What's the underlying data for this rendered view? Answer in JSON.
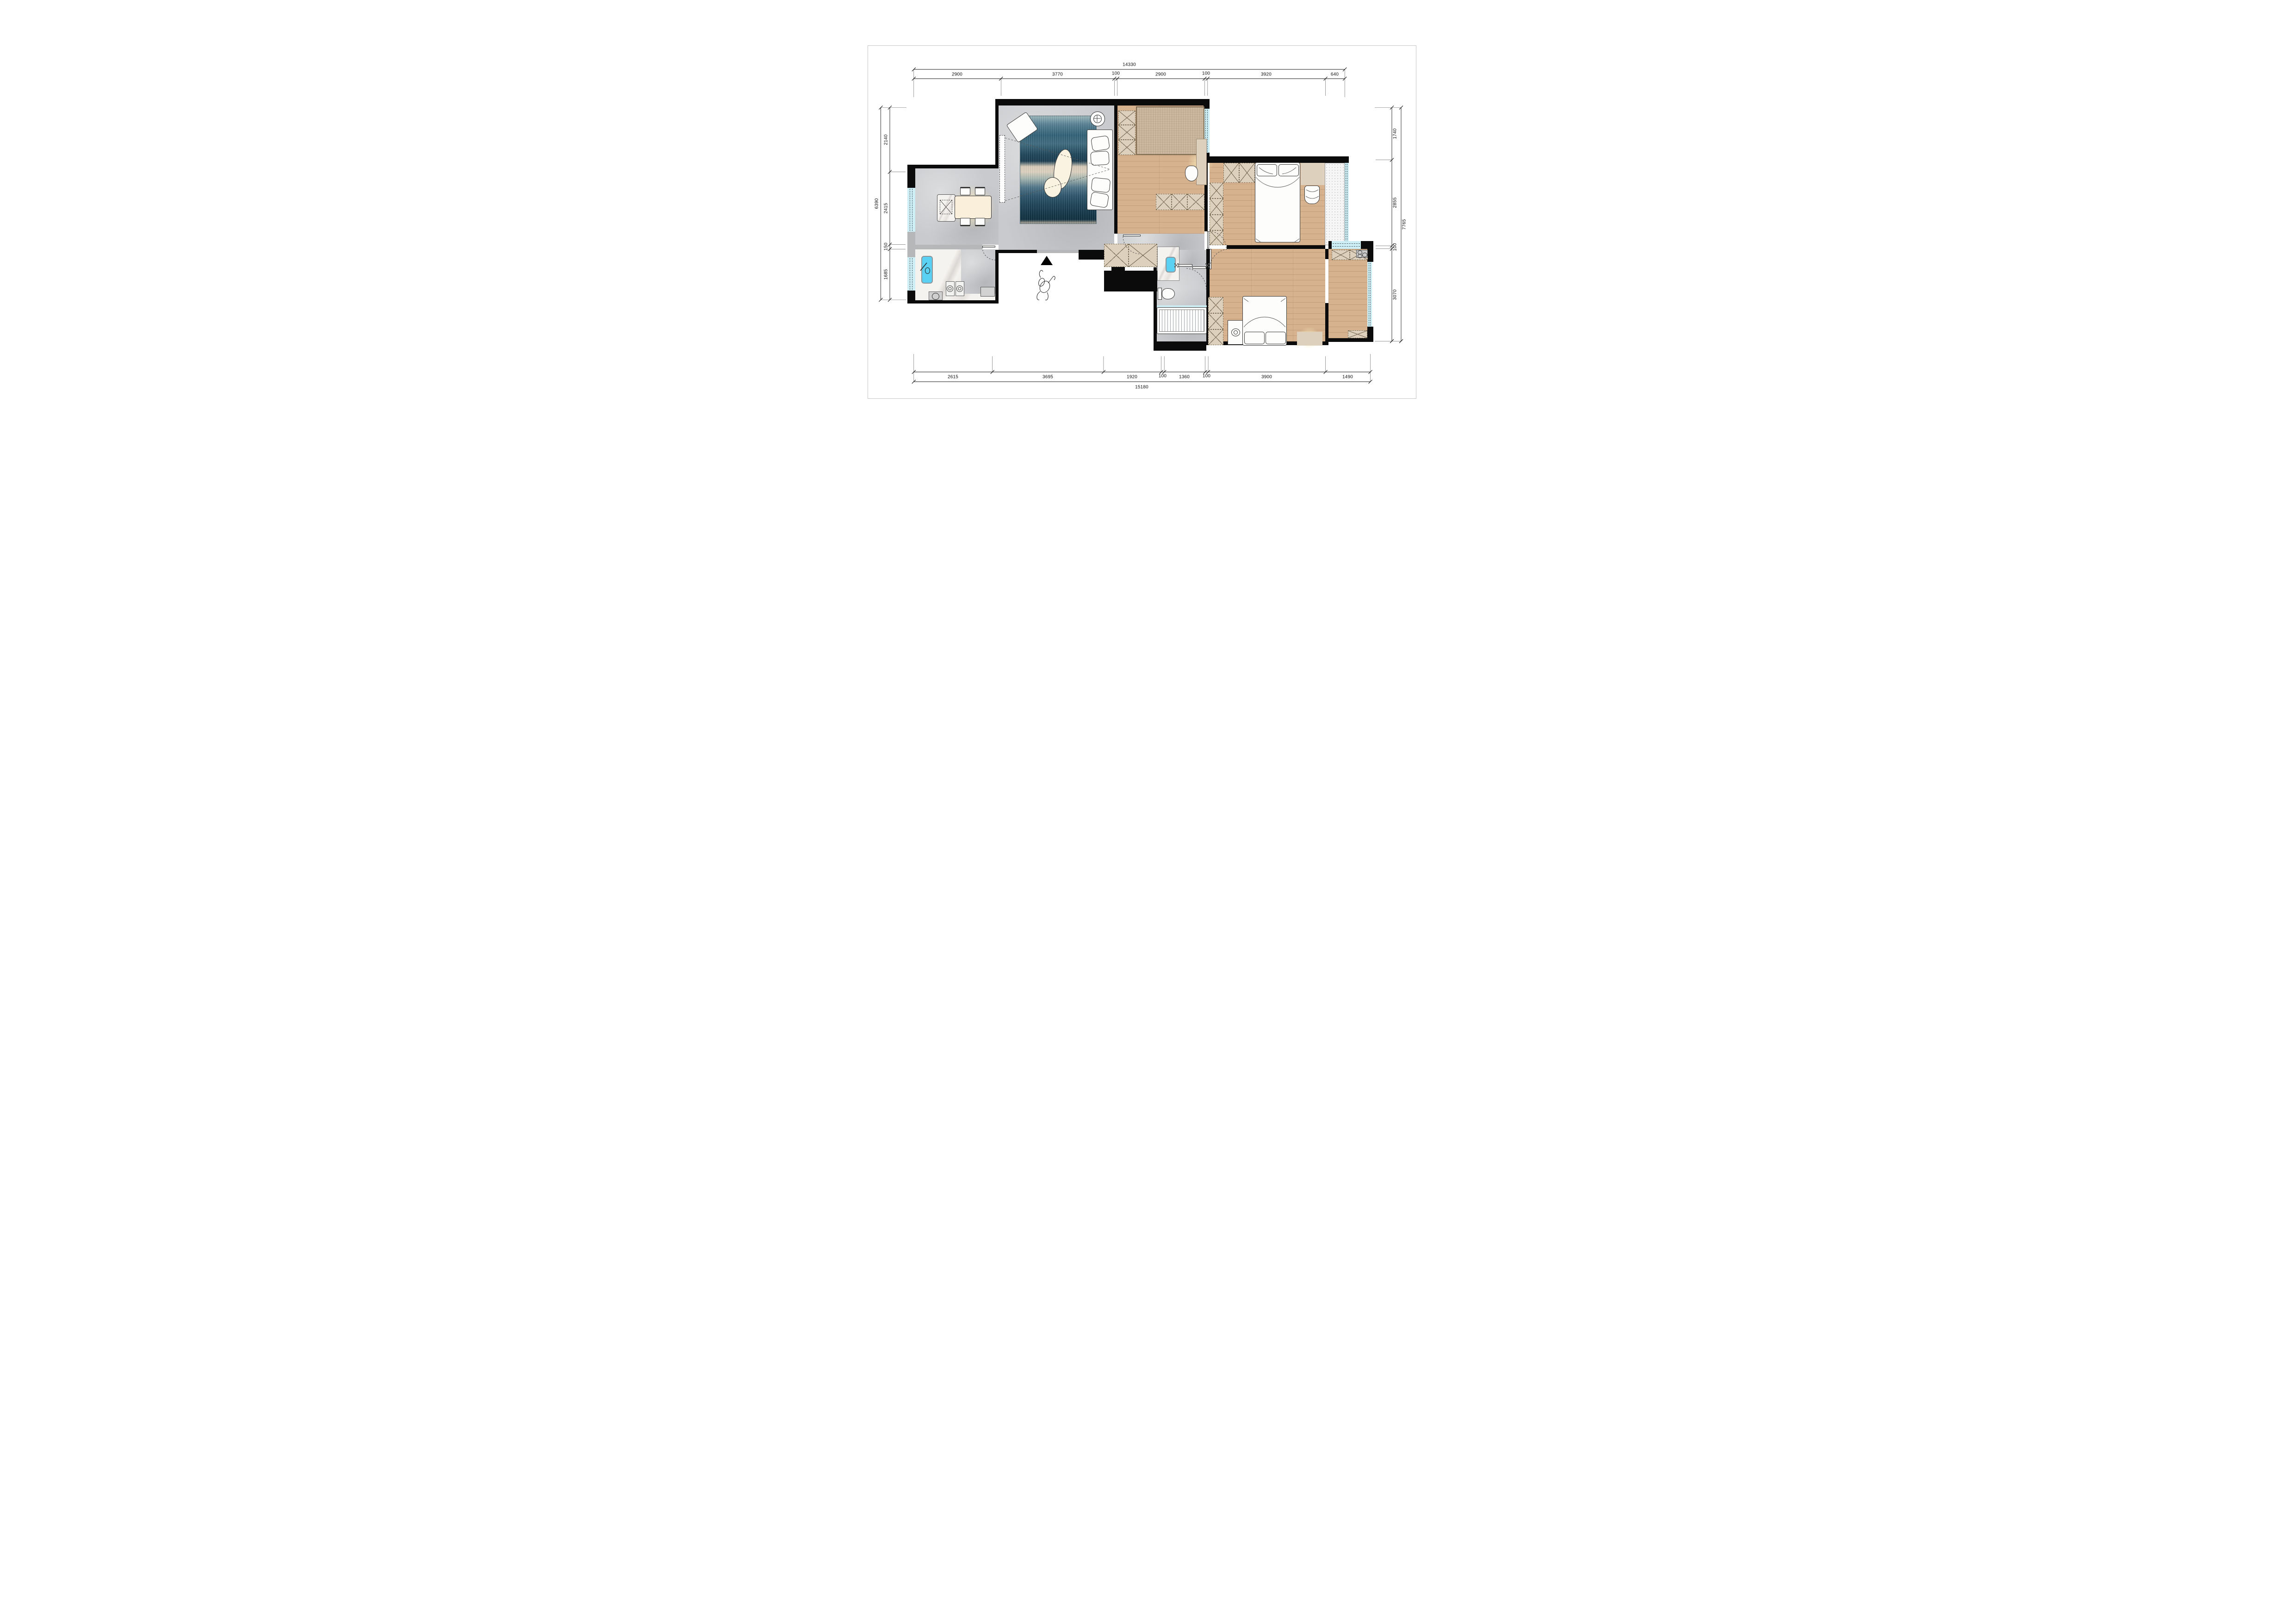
{
  "dimensions": {
    "top": {
      "total": "14330",
      "segments": [
        "2900",
        "3770",
        "100",
        "2900",
        "100",
        "3920",
        "640"
      ]
    },
    "bottom": {
      "total": "15180",
      "segments": [
        "2615",
        "3695",
        "1920",
        "100",
        "1360",
        "100",
        "3900",
        "1490"
      ]
    },
    "left": {
      "total": "6390",
      "segments": [
        "2140",
        "2415",
        "150",
        "1685"
      ]
    },
    "right": {
      "total": "7765",
      "segments": [
        "1740",
        "2855",
        "100",
        "3070"
      ]
    }
  },
  "colors": {
    "wall": "#0b0b0b",
    "window": "#cdeef5",
    "winline": "#4a5a5e",
    "concrete": "#c9cacd",
    "wood": "#d6b28e",
    "furn": "#ddd0bc",
    "marble": "#f5f3ef",
    "sink": "#5ad0f2"
  },
  "icons": {
    "entry-arrow-icon": "black-triangle-up",
    "person-top-view-icon": "sketch-outline",
    "ceiling-lamp-icon": "circle-with-cross",
    "gas-burner-icon": "concentric-circles",
    "sink-faucet-icon": "diagonal-lever",
    "toilet-icon": "tank-and-bowl",
    "bathtub-icon": "slatted-rectangle",
    "wardrobe-icon": "crossed-box",
    "floor-drain-icon": "circle-in-square",
    "door-swing-icon": "dashed-quarter-arc",
    "tv-projection-icon": "dashed-cone"
  }
}
